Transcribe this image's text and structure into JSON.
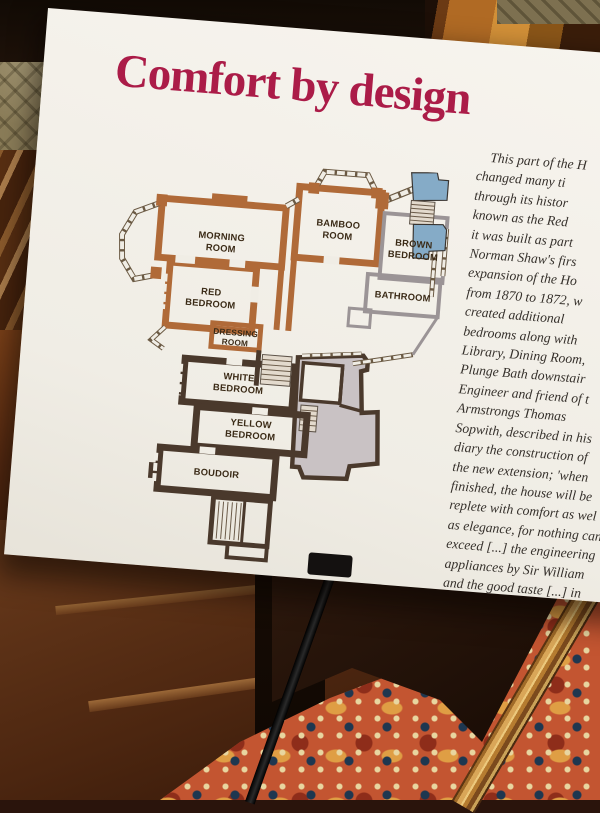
{
  "board": {
    "title": "Comfort by design"
  },
  "plan": {
    "labels": {
      "morning_1": "MORNING",
      "morning_2": "ROOM",
      "bamboo_1": "BAMBOO",
      "bamboo_2": "ROOM",
      "brown_1": "BROWN",
      "brown_2": "BEDROOM",
      "red_1": "RED",
      "red_2": "BEDROOM",
      "bathroom": "BATHROOM",
      "dressing_1": "DRESSING",
      "dressing_2": "ROOM",
      "white_1": "WHITE",
      "white_2": "BEDROOM",
      "yellow_1": "YELLOW",
      "yellow_2": "BEDROOM",
      "boudoir": "BOUDOIR"
    }
  },
  "article": {
    "lines": [
      "This part of the H",
      "changed many ti",
      "through its histor",
      "known as the Red",
      "it was built as part",
      "Norman Shaw's firs",
      "expansion of the Ho",
      "from 1870 to 1872, w",
      "created additional",
      "bedrooms along with",
      "Library, Dining Room,",
      "Plunge Bath downstair",
      "Engineer and friend of t",
      "Armstrongs Thomas",
      "Sopwith, described in his",
      "diary the construction of",
      "the new extension; 'when",
      "finished, the house will be",
      "replete with comfort as wel",
      "as elegance, for nothing can",
      "exceed [...] the engineering",
      "appliances by Sir William",
      "and the good taste [...] in"
    ]
  },
  "colors": {
    "title_red": "#ab1c48",
    "sign_bg": "#f0ede5",
    "body_ink": "#35302b",
    "plan_orange": "#b06a38",
    "plan_grey": "#9b9496",
    "plan_dark": "#4a392c",
    "plan_blue": "#85abc7",
    "plan_grey_fill": "#c9c2c4",
    "plan_stair": "#e3dacd",
    "plan_label_ink": "#3a2a16",
    "carpet_red": "#c35531",
    "frame_gold": "#b67c30",
    "wood_brown": "#5a2c12"
  }
}
